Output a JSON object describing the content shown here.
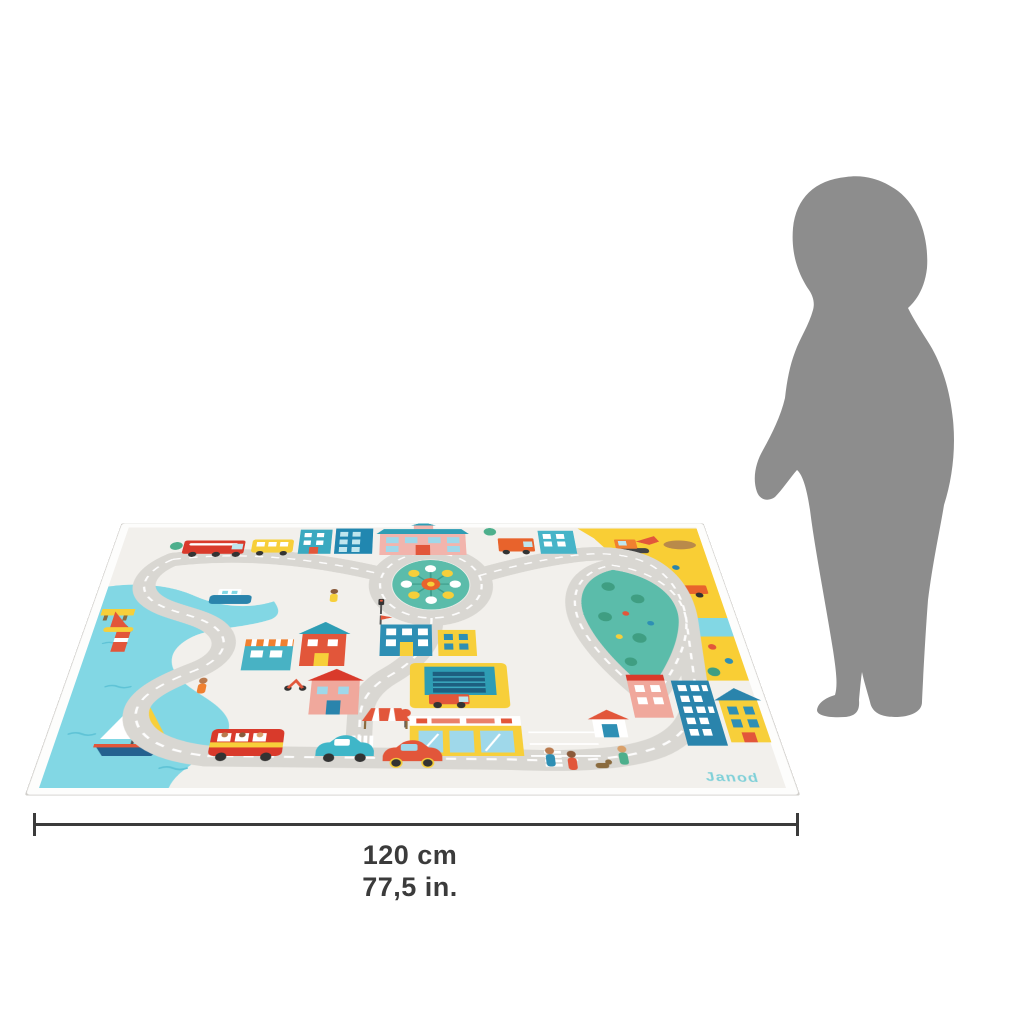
{
  "product": {
    "mat": {
      "brand_logo": "Janod",
      "theme": "city-road-play-mat"
    },
    "size_reference": {
      "width_cm": "120 cm",
      "width_in": "77,5 in."
    },
    "colors": {
      "mat_background": "#f2f0ec",
      "mat_border": "#fdfdfc",
      "road": "#d9d7d2",
      "road_dash": "#ffffff",
      "water": "#82d7e4",
      "park_green": "#5bbcaa",
      "construction_yellow": "#f9ce35",
      "accent_red": "#e2563a",
      "accent_orange": "#f08030",
      "accent_teal": "#3aa9c0",
      "accent_blue": "#2a84ac",
      "accent_pink": "#f2b4ac",
      "silhouette_gray": "#8d8d8d",
      "dimension_line": "#3b3b3b",
      "logo_teal": "#7fd0d8"
    }
  }
}
